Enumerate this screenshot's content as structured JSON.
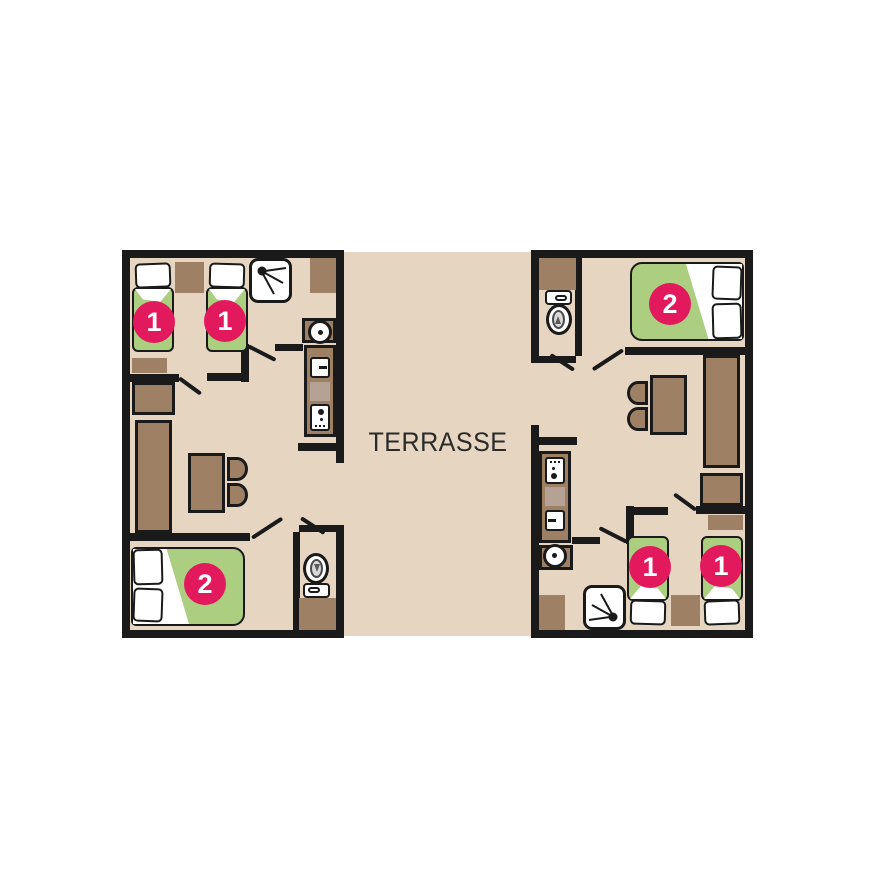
{
  "plan": {
    "terrace_label": "TERRASSE",
    "units": [
      {
        "id": "left",
        "badges": {
          "twin_a": "1",
          "twin_b": "1",
          "double": "2"
        }
      },
      {
        "id": "right",
        "badges": {
          "twin_a": "1",
          "twin_b": "1",
          "double": "2"
        }
      }
    ],
    "colors": {
      "background": "#ffffff",
      "floor": "#e6d6c1",
      "wall": "#1a1a1a",
      "furniture": "#9e8065",
      "furniture_light": "#b5a294",
      "bed_green": "#abce81",
      "badge": "#e2195c",
      "badge_text": "#ffffff",
      "label_text": "#2a2a2a"
    }
  }
}
